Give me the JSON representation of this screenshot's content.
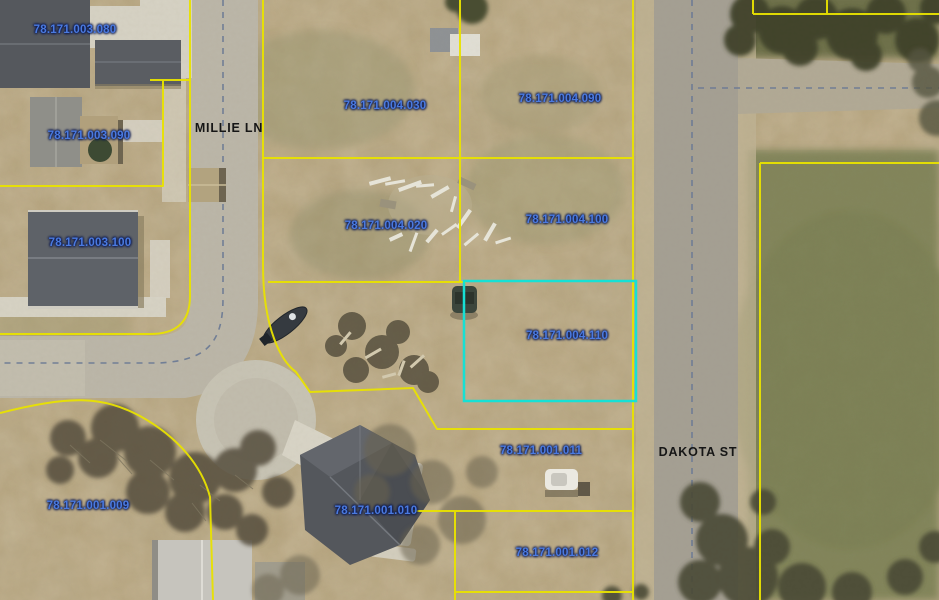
{
  "map": {
    "type": "aerial-parcel-map",
    "streets": [
      {
        "name": "MILLIE LN"
      },
      {
        "name": "DAKOTA ST"
      }
    ],
    "parcels": [
      {
        "id": "78.171.003.080"
      },
      {
        "id": "78.171.004.030"
      },
      {
        "id": "78.171.004.090"
      },
      {
        "id": "78.171.003.090"
      },
      {
        "id": "78.171.004.020"
      },
      {
        "id": "78.171.004.100"
      },
      {
        "id": "78.171.003.100"
      },
      {
        "id": "78.171.004.110",
        "highlighted": true
      },
      {
        "id": "78.171.001.011"
      },
      {
        "id": "78.171.001.009"
      },
      {
        "id": "78.171.001.010"
      },
      {
        "id": "78.171.001.012"
      }
    ],
    "highlight": {
      "parcel_id": "78.171.004.110",
      "color": "#17e0d4"
    },
    "colors": {
      "parcel_line": "#e8e200",
      "parcel_label": "#4a7ae0",
      "street_label": "#161616",
      "highlight": "#17e0d4"
    }
  }
}
